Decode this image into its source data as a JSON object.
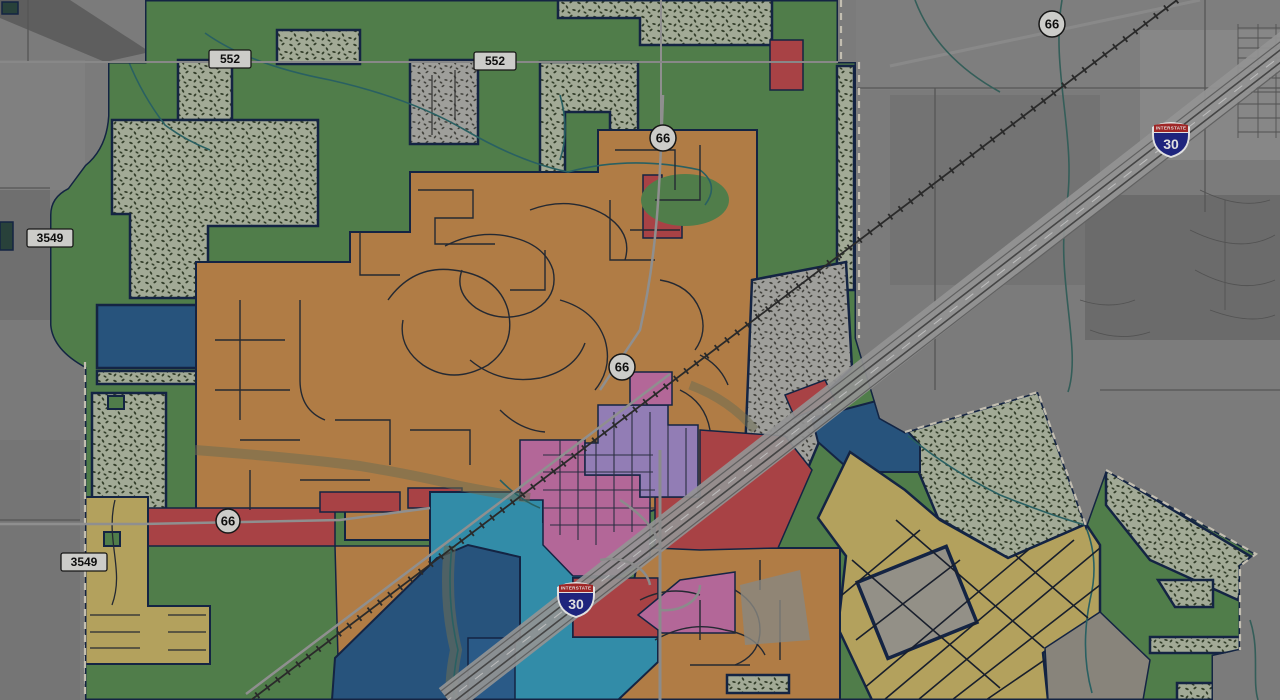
{
  "shields": {
    "route_552": {
      "label": "552"
    },
    "route_66": {
      "label": "66"
    },
    "route_3549": {
      "label": "3549"
    },
    "interstate_30": {
      "label": "30",
      "banner": "INTERSTATE"
    }
  },
  "palette": {
    "aerial_gray": "#8c8c8c",
    "zone_green": "#5c8f55",
    "zone_orange": "#c98e4f",
    "zone_red": "#c04c4f",
    "zone_blue": "#2d5f8e",
    "zone_cyan": "#3aa0c0",
    "zone_pink": "#cc76ad",
    "zone_lavender": "#a78fcf",
    "zone_khaki": "#ccb86a",
    "stipple_green_base": "#b9c2ab",
    "stipple_gray_base": "#b6b6b1",
    "boundary_navy": "#17294d",
    "dashed_boundary": "#ded9ca",
    "stream_teal": "#2f6e70",
    "highway_gray": "#a8a8a8",
    "railroad_dark": "#303030"
  }
}
